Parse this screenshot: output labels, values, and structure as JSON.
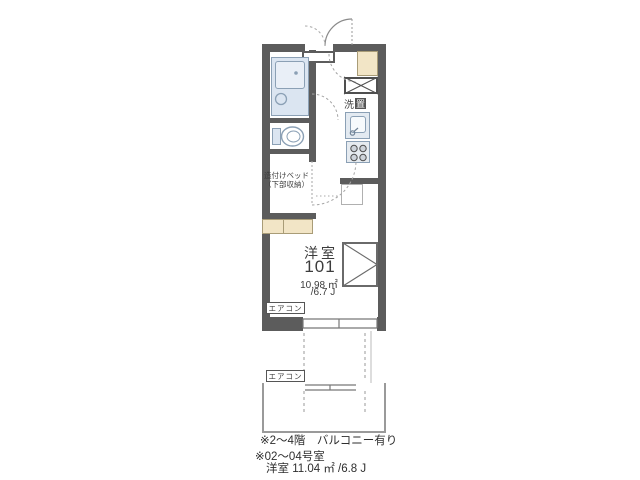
{
  "colors": {
    "wall": "#5c5c5c",
    "fixture_fill": "#dbe5f1",
    "fixture_border": "#8ba0b5",
    "wood_beige": "#f2e5c6",
    "line_gray": "#999999",
    "text": "#3c3c3c"
  },
  "floorplan": {
    "room": {
      "name": "洋室",
      "number": "101",
      "area": "10.98 ㎡",
      "tatami": "/6.7 J"
    },
    "labels": {
      "bed_line1": "造付けベッド",
      "bed_line2": "（下部収納）",
      "washer_char1": "洗",
      "washer_char2": "置",
      "aircon_room": "エアコン",
      "aircon_balcony": "エアコン"
    },
    "notes": [
      "※2～4階　バルコニー有り",
      "※02～04号室",
      "洋室 11.04 ㎡ /6.8 J"
    ]
  }
}
